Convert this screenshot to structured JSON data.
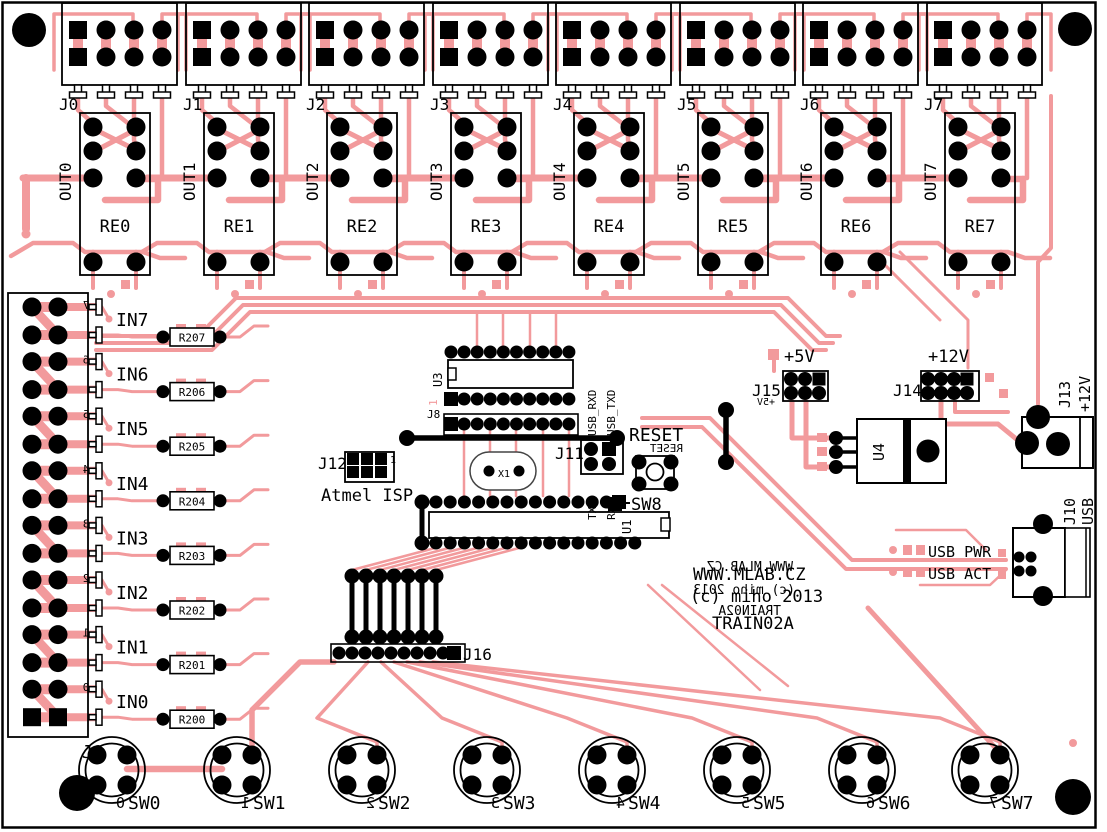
{
  "board": {
    "site": "WWW.MLAB.CZ",
    "copyright": "(c) miho 2013",
    "title": "TRAIN02A",
    "colors": {
      "trace": "#f29a9c",
      "silk": "#000000",
      "board": "#ffffff"
    }
  },
  "output_channels": [
    {
      "connector": "J0",
      "out": "OUT0",
      "relay": "RE0"
    },
    {
      "connector": "J1",
      "out": "OUT1",
      "relay": "RE1"
    },
    {
      "connector": "J2",
      "out": "OUT2",
      "relay": "RE2"
    },
    {
      "connector": "J3",
      "out": "OUT3",
      "relay": "RE3"
    },
    {
      "connector": "J4",
      "out": "OUT4",
      "relay": "RE4"
    },
    {
      "connector": "J5",
      "out": "OUT5",
      "relay": "RE5"
    },
    {
      "connector": "J6",
      "out": "OUT6",
      "relay": "RE6"
    },
    {
      "connector": "J7",
      "out": "OUT7",
      "relay": "RE7"
    }
  ],
  "input_connector": {
    "label": "J9"
  },
  "inputs": [
    {
      "label": "IN7",
      "resistor": "R207",
      "pin": "7"
    },
    {
      "label": "IN6",
      "resistor": "R206",
      "pin": "6"
    },
    {
      "label": "IN5",
      "resistor": "R205",
      "pin": "5"
    },
    {
      "label": "IN4",
      "resistor": "R204",
      "pin": "4"
    },
    {
      "label": "IN3",
      "resistor": "R203",
      "pin": "3"
    },
    {
      "label": "IN2",
      "resistor": "R202",
      "pin": "2"
    },
    {
      "label": "IN1",
      "resistor": "R201",
      "pin": "1"
    },
    {
      "label": "IN0",
      "resistor": "R200",
      "pin": "0"
    }
  ],
  "switches": [
    {
      "label": "SW0",
      "pin": "0"
    },
    {
      "label": "SW1",
      "pin": "1"
    },
    {
      "label": "SW2",
      "pin": "2"
    },
    {
      "label": "SW3",
      "pin": "3"
    },
    {
      "label": "SW4",
      "pin": "4"
    },
    {
      "label": "SW5",
      "pin": "5"
    },
    {
      "label": "SW6",
      "pin": "6"
    },
    {
      "label": "SW7",
      "pin": "7"
    }
  ],
  "ics": {
    "u3": "U3",
    "u1": "U1",
    "u4": "U4",
    "x1": "X1",
    "pin1": "1"
  },
  "headers": {
    "j8": "J8",
    "j11": "J11",
    "j12": "J12",
    "j12_desc": "Atmel ISP",
    "j16": "J16"
  },
  "serial": {
    "top": [
      "USB_RXD",
      "USB_TXD"
    ],
    "bottom": [
      "TXD",
      "RXD"
    ]
  },
  "reset": {
    "label": "RESET",
    "switch": "SW8"
  },
  "power": {
    "v5": "+5V",
    "j15": "J15",
    "v12": "+12V",
    "j14": "J14",
    "j13": "J13",
    "j13_desc": "+12V"
  },
  "usb": {
    "j10": "J10",
    "j10_desc": "USB",
    "pwr": "USB PWR",
    "act": "USB ACT"
  }
}
